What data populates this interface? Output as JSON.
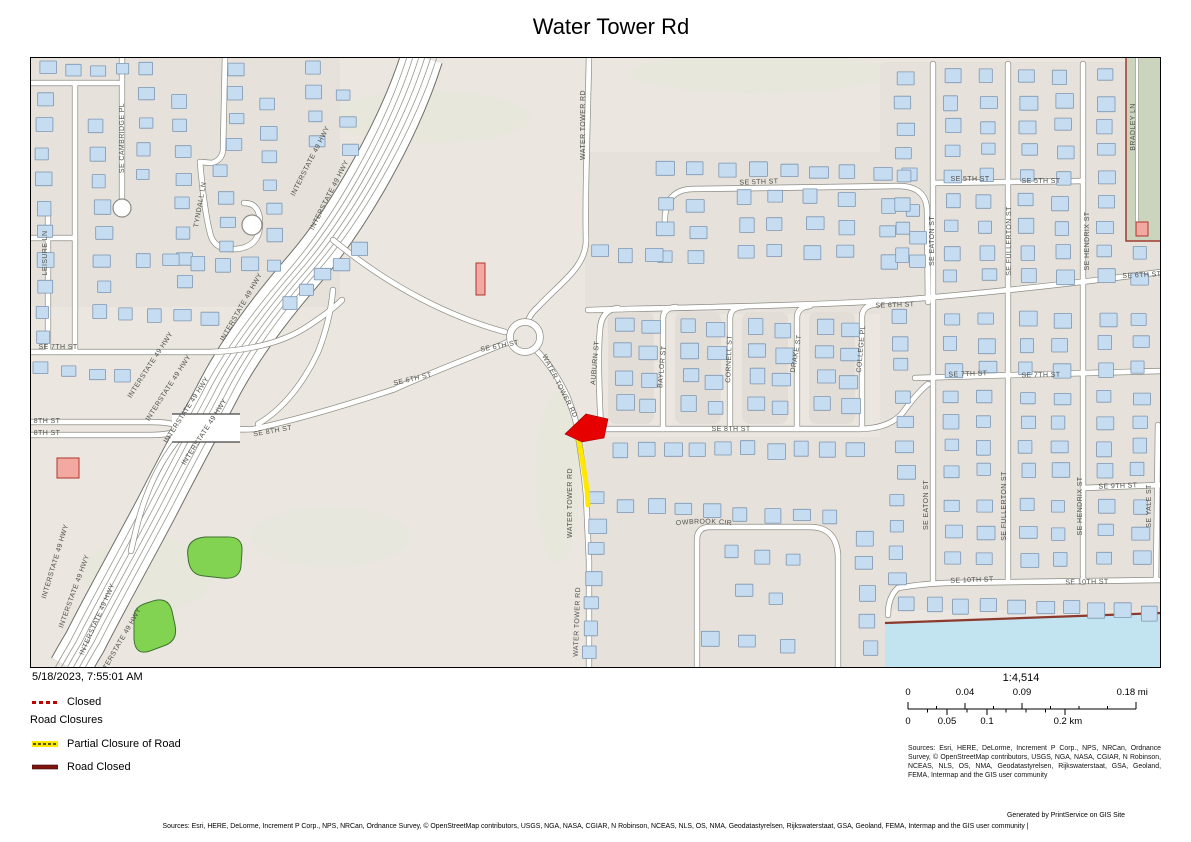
{
  "title": "Water Tower Rd",
  "header_date": "5/18/2023, 7:55:01 AM",
  "legend": {
    "closed_label": "Closed",
    "group_label": "Road Closures",
    "partial_label": "Partial Closure of Road",
    "road_closed_label": "Road Closed"
  },
  "scale": {
    "ratio": "1:4,514",
    "mi": [
      "0",
      "0.04",
      "0.09",
      "0.18 mi"
    ],
    "km": [
      "0",
      "0.05",
      "0.1",
      "0.2 km"
    ]
  },
  "attribution": {
    "sources_box": "Sources: Esri, HERE, DeLorme, Increment P Corp., NPS, NRCan, Ordnance Survey, © OpenStreetMap contributors, USGS, NGA, NASA, CGIAR, N Robinson, NCEAS, NLS, OS, NMA, Geodatastyrelsen, Rijkswaterstaat, GSA, Geoland, FEMA, Intermap and the GIS user community",
    "generated_by": "Generated by PrintService on GIS Site",
    "bottom_line": "Sources: Esri, HERE, DeLorme, Increment P Corp., NPS, NRCan, Ordnance Survey, © OpenStreetMap contributors, USGS, NGA, NASA, CGIAR, N Robinson, NCEAS, NLS, OS, NMA, Geodatastyrelsen, Rijkswaterstaat, GSA, Geoland, FEMA, Intermap and the GIS user community |"
  },
  "map": {
    "colors": {
      "base": "#EBE6E0",
      "block": "#E6E1DB",
      "block_inner": "#E2DDD7",
      "tint_green": "#E3E8D8",
      "road_fill": "#FFFFFF",
      "road_casing": "#8C8C83",
      "hwy_casing": "#6F6F66",
      "lane_line": "#9A9A92",
      "building": "#C6DDF1",
      "building_outline": "#7E96B1",
      "park": "#83D353",
      "park_outline": "#3F7030",
      "sage": "#CBD5BE",
      "sage_border": "#A23A2F",
      "water": "#C2E4F0",
      "water_edge": "#8C3A2E",
      "pink_building": "#F2A9A2",
      "pink_outline": "#B0352B",
      "closure_red": "#E60000",
      "closure_yellow": "#FFE800",
      "legend_closed_red": "#C00000",
      "road_closed_maroon": "#7E120C"
    },
    "highway_label": "INTERSTATE 49 HWY",
    "street_labels": [
      {
        "text": "SE CAMBRIDGE PL",
        "x": 94,
        "y": 81,
        "r": -90
      },
      {
        "text": "TYNDALL LN",
        "x": 172,
        "y": 148,
        "r": -80
      },
      {
        "text": "LEISURE LN",
        "x": 17,
        "y": 196,
        "r": -90
      },
      {
        "text": "SE 7TH ST",
        "x": 28,
        "y": 292,
        "r": 0
      },
      {
        "text": "8TH ST",
        "x": 17,
        "y": 366,
        "r": 0
      },
      {
        "text": "8TH ST",
        "x": 17,
        "y": 378,
        "r": 0
      },
      {
        "text": "SE 8TH ST",
        "x": 243,
        "y": 376,
        "r": -10
      },
      {
        "text": "SE 6TH ST",
        "x": 383,
        "y": 324,
        "r": -13
      },
      {
        "text": "SE 6TH ST",
        "x": 470,
        "y": 291,
        "r": -11
      },
      {
        "text": "WATER TOWER RD",
        "x": 555,
        "y": 68,
        "r": -90
      },
      {
        "text": "WATER TOWER RD",
        "x": 528,
        "y": 330,
        "r": 63
      },
      {
        "text": "WATER TOWER RD",
        "x": 542,
        "y": 446,
        "r": -90
      },
      {
        "text": "WATER TOWER RD",
        "x": 549,
        "y": 565,
        "r": -88
      },
      {
        "text": "AUBURN ST",
        "x": 567,
        "y": 306,
        "r": -85
      },
      {
        "text": "BAYLOR ST",
        "x": 634,
        "y": 310,
        "r": -85
      },
      {
        "text": "CORNELL ST",
        "x": 701,
        "y": 302,
        "r": -88
      },
      {
        "text": "DRAKE ST",
        "x": 768,
        "y": 297,
        "r": -80
      },
      {
        "text": "COLLEGE PL",
        "x": 833,
        "y": 292,
        "r": -85
      },
      {
        "text": "SE 5TH ST",
        "x": 729,
        "y": 127,
        "r": -2
      },
      {
        "text": "SE 5TH ST",
        "x": 940,
        "y": 124,
        "r": 0
      },
      {
        "text": "SE 5TH ST",
        "x": 1011,
        "y": 126,
        "r": 0
      },
      {
        "text": "SE 6TH ST",
        "x": 865,
        "y": 250,
        "r": -2
      },
      {
        "text": "SE 6TH ST",
        "x": 1112,
        "y": 220,
        "r": -3
      },
      {
        "text": "SE 7TH ST",
        "x": 938,
        "y": 319,
        "r": -2
      },
      {
        "text": "SE 7TH ST",
        "x": 1011,
        "y": 320,
        "r": -1
      },
      {
        "text": "SE 8TH ST",
        "x": 701,
        "y": 374,
        "r": 0
      },
      {
        "text": "SE 9TH ST",
        "x": 1088,
        "y": 431,
        "r": -2
      },
      {
        "text": "SE 10TH ST",
        "x": 942,
        "y": 525,
        "r": -2
      },
      {
        "text": "SE 10TH ST",
        "x": 1057,
        "y": 527,
        "r": -1
      },
      {
        "text": "SE EATON ST",
        "x": 904,
        "y": 184,
        "r": -90
      },
      {
        "text": "SE EATON ST",
        "x": 898,
        "y": 448,
        "r": -90
      },
      {
        "text": "SE FULLERTON ST",
        "x": 981,
        "y": 184,
        "r": -90
      },
      {
        "text": "SE FULLERTON ST",
        "x": 976,
        "y": 449,
        "r": -90
      },
      {
        "text": "SE HENDRIX ST",
        "x": 1059,
        "y": 184,
        "r": -90
      },
      {
        "text": "SE HENDRIX ST",
        "x": 1052,
        "y": 449,
        "r": -90
      },
      {
        "text": "BRADLEY LN",
        "x": 1105,
        "y": 70,
        "r": -90
      },
      {
        "text": "SE YALE ST",
        "x": 1121,
        "y": 449,
        "r": -90
      },
      {
        "text": "MEADOWBROOK CIR",
        "path": "mbpath"
      }
    ]
  }
}
